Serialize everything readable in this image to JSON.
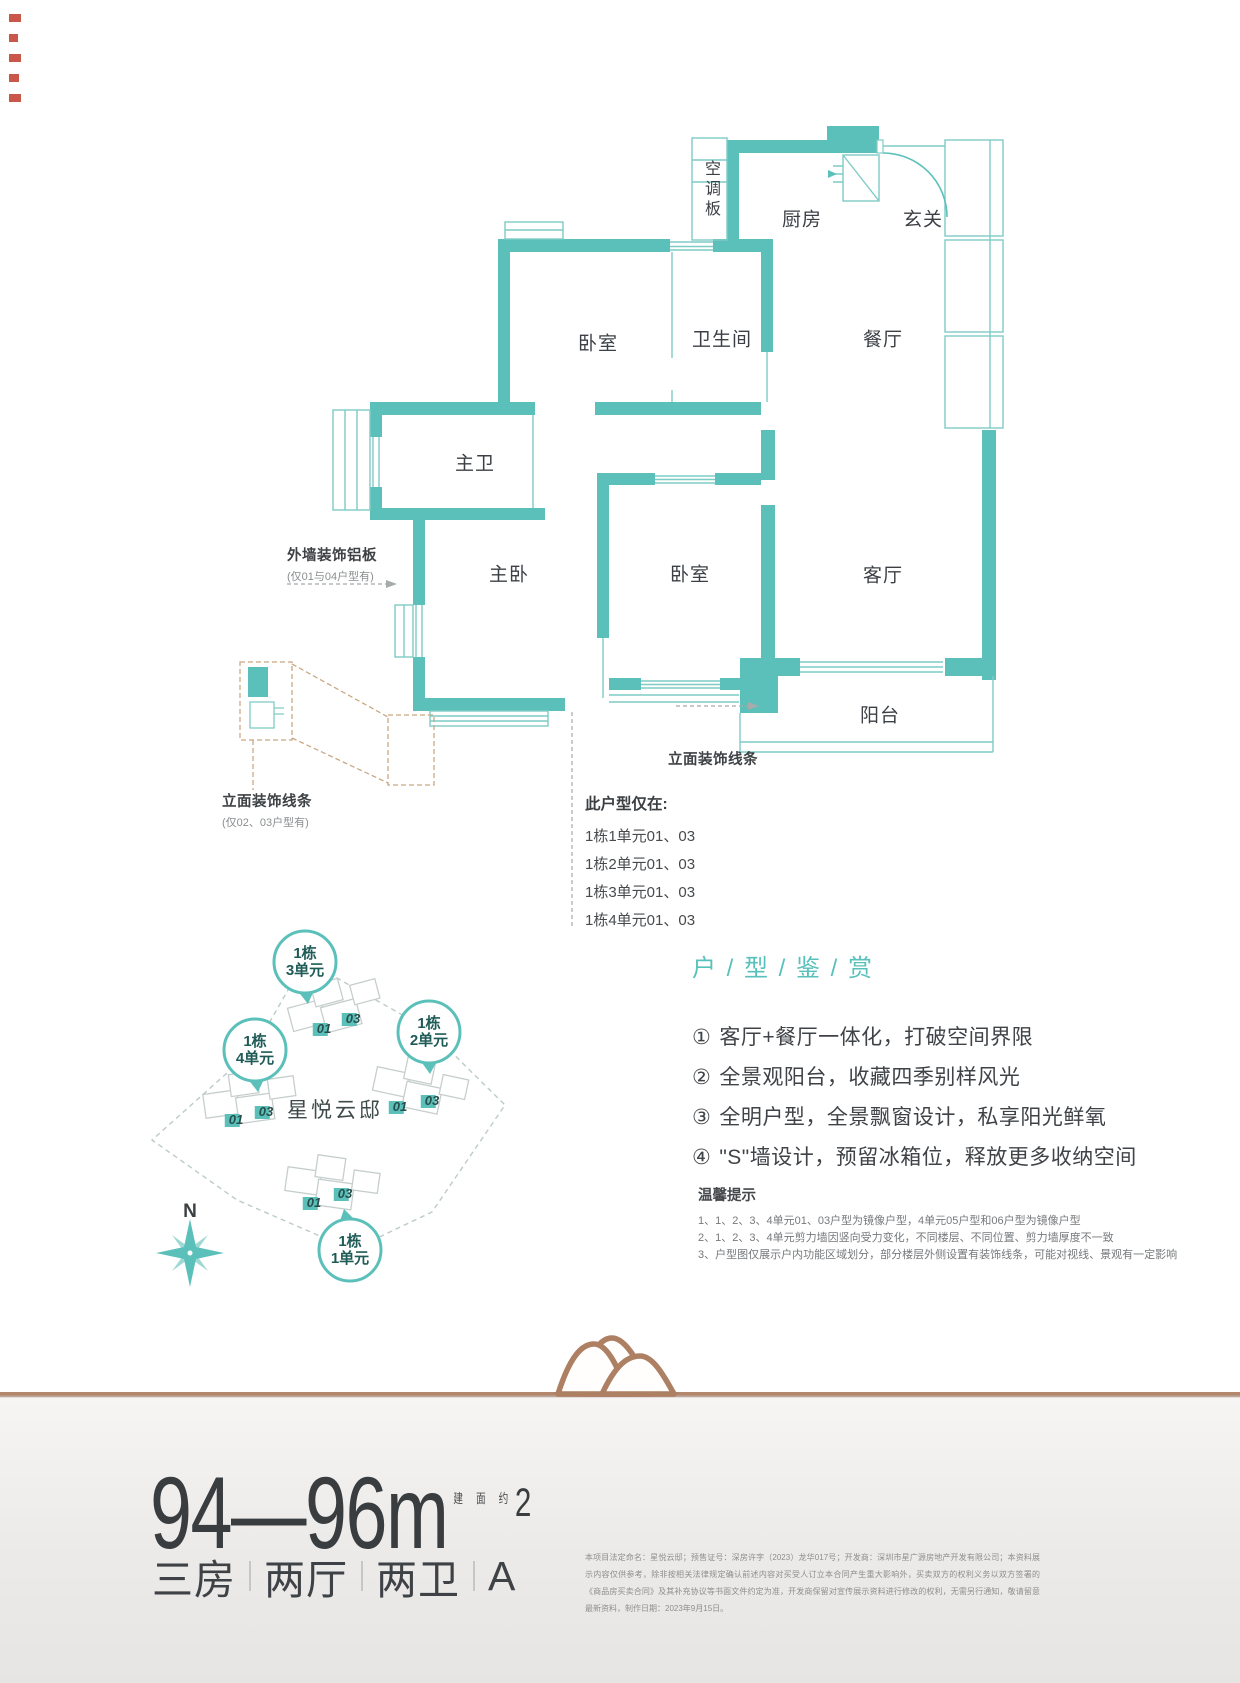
{
  "plan": {
    "rooms": {
      "ac": "空调板",
      "kitchen": "厨房",
      "foyer": "玄关",
      "bedroom1": "卧室",
      "bath": "卫生间",
      "dining": "餐厅",
      "master_bath": "主卫",
      "master_bed": "主卧",
      "bedroom2": "卧室",
      "living": "客厅",
      "balcony": "阳台"
    },
    "annotations": {
      "exterior_panel": {
        "title": "外墙装饰铝板",
        "note": "(仅01与04户型有)"
      },
      "facade_line_left": {
        "title": "立面装饰线条",
        "note": "(仅02、03户型有)"
      },
      "facade_line_mid": {
        "title": "立面装饰线条"
      }
    },
    "availability": {
      "title": "此户型仅在:",
      "items": [
        "1栋1单元01、03",
        "1栋2单元01、03",
        "1栋3单元01、03",
        "1栋4单元01、03"
      ]
    }
  },
  "siteplan": {
    "project_name": "星悦云邸",
    "north_label": "N",
    "circles": [
      {
        "line1": "1栋",
        "line2": "3单元"
      },
      {
        "line1": "1栋",
        "line2": "2单元"
      },
      {
        "line1": "1栋",
        "line2": "4单元"
      },
      {
        "line1": "1栋",
        "line2": "1单元"
      }
    ],
    "markers": [
      "01",
      "03",
      "01",
      "03",
      "01",
      "03",
      "01",
      "03"
    ]
  },
  "features": {
    "heading": "户 / 型 / 鉴 / 赏",
    "items": [
      {
        "num": "①",
        "text": "客厅+餐厅一体化，打破空间界限"
      },
      {
        "num": "②",
        "text": "全景观阳台，收藏四季别样风光"
      },
      {
        "num": "③",
        "text": "全明户型，全景飘窗设计，私享阳光鲜氧"
      },
      {
        "num": "④",
        "text": "\"S\"墙设计，预留冰箱位，释放更多收纳空间"
      }
    ],
    "tips": {
      "title": "温馨提示",
      "items": [
        "1、1、2、3、4单元01、03户型为镜像户型，4单元05户型和06户型为镜像户型",
        "2、1、2、3、4单元剪力墙因竖向受力变化，不同楼层、不同位置、剪力墙厚度不一致",
        "3、户型图仅展示户内功能区域划分，部分楼层外侧设置有装饰线条，可能对视线、景观有一定影响"
      ]
    }
  },
  "footer": {
    "area_min": "94",
    "area_dash": "—",
    "area_max": "96",
    "area_unit": "m",
    "area_sup": "2",
    "area_note": "建 面 约",
    "layout": [
      "三房",
      "两厅",
      "两卫",
      "A"
    ],
    "disclaimer": "本项目法定命名：星悦云邸；预售证号：深房许字（2023）龙华017号；开发商：深圳市星广源房地产开发有限公司；本资料展示内容仅供参考，除非按相关法律规定确认前述内容对买受人订立本合同产生重大影响外，买卖双方的权利义务以双方签署的《商品房买卖合同》及其补充协议等书面文件约定为准，开发商保留对宣传展示资料进行修改的权利，无需另行通知，敬请留意最新资料，制作日期：2023年9月15日。"
  },
  "colors": {
    "accent": "#5CC0BA",
    "bronze": "#AD7F63",
    "text": "#3B3F42"
  }
}
